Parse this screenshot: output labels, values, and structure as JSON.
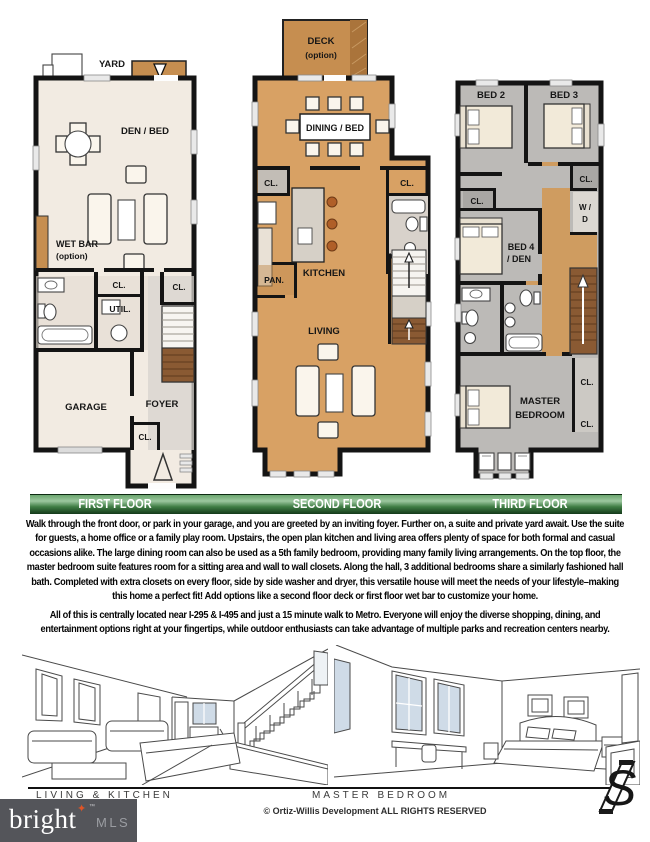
{
  "floors": {
    "first": {
      "bar_label": "FIRST FLOOR",
      "yard": "YARD",
      "den_bed": "DEN / BED",
      "wet_bar_line1": "WET BAR",
      "wet_bar_line2": "(option)",
      "closet_hall": "CL.",
      "utility": "UTIL.",
      "closet_stairs": "CL.",
      "garage": "GARAGE",
      "foyer": "FOYER",
      "closet_foyer": "CL."
    },
    "second": {
      "bar_label": "SECOND FLOOR",
      "deck_line1": "DECK",
      "deck_line2": "(option)",
      "dining": "DINING / BED",
      "closet_left": "CL.",
      "closet_right": "CL.",
      "kitchen": "KITCHEN",
      "pantry": "PAN.",
      "living": "LIVING"
    },
    "third": {
      "bar_label": "THIRD FLOOR",
      "bed2": "BED 2",
      "bed3": "BED 3",
      "closet_top": "CL.",
      "washer_dryer_line1": "W /",
      "washer_dryer_line2": "D",
      "closet_bed4": "CL.",
      "bed4_line1": "BED 4",
      "bed4_line2": "/ DEN",
      "master_line1": "MASTER",
      "master_line2": "BEDROOM",
      "closet_master_1": "CL.",
      "closet_master_2": "CL."
    }
  },
  "description": {
    "paragraph1": "Walk through the front door, or park in your garage, and you are greeted by an inviting foyer. Further on, a suite and private yard await. Use the suite for guests, a home office or a family play room. Upstairs, the open plan kitchen and living area offers plenty of space for both formal and casual occasions alike. The large dining room can also be used as a 5th family bedroom, providing many family living arrangements. On the top floor, the master bedroom suite features room for a sitting area and wall to wall closets. Along the hall, 3 additional bedrooms share a similarly fashioned hall bath. Completed with extra closets on every floor, side by side washer and dryer, this versatile house will meet the needs of your lifestyle–making this home a perfect fit!  Add options like a second floor deck or first floor wet bar to customize your home.",
    "paragraph2": "All of this is centrally located near I-295 & I-495 and just a 15 minute walk to Metro. Everyone will enjoy the diverse shopping, dining, and entertainment options right at your fingertips, while outdoor enthusiasts can take advantage of multiple parks and recreation centers nearby."
  },
  "renderings": {
    "left_caption": "LIVING & KITCHEN",
    "right_caption": "MASTER BEDROOM"
  },
  "footer": {
    "copyright": "© Ortiz-Willis Development  ALL RIGHTS RESERVED"
  },
  "branding": {
    "bright_mls_word": "bright",
    "bright_mls_suffix": "MLS",
    "trademark": "™",
    "developer_monogram": "S"
  },
  "colors": {
    "bar_green_dark": "#14391a",
    "bar_green_light": "#9cc79e",
    "floor1_cream": "#f2ebe2",
    "floor2_tan": "#d8a164",
    "floor3_gray": "#bcbab7",
    "hall_tan": "#cf9c60",
    "stair_brown": "#8a5a33",
    "deck_tan": "#c68e50",
    "logo_bg": "#54555a",
    "logo_star_orange": "#e05426",
    "window_glass": "#cfdbe7"
  }
}
